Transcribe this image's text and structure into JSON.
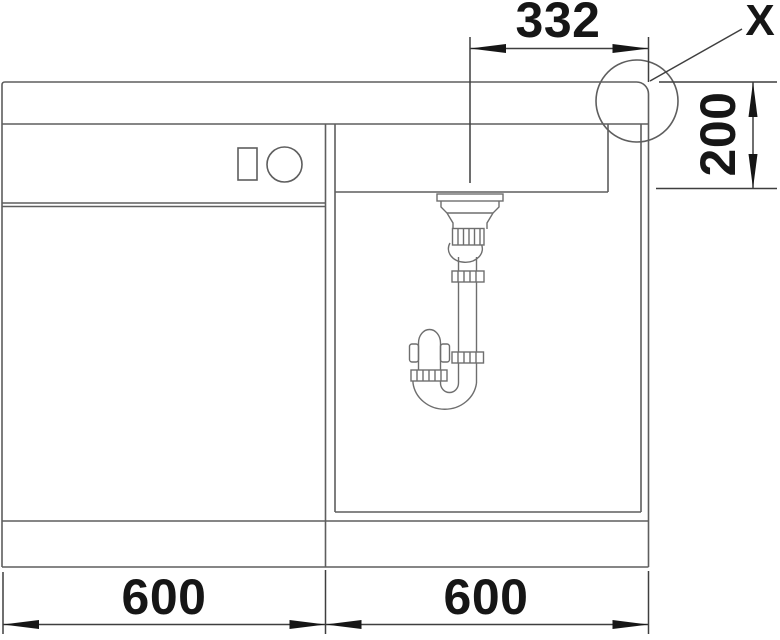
{
  "diagram": {
    "type": "technical-installation-drawing",
    "detail_label": "X",
    "dimensions": {
      "drain_center_to_right_edge": "332",
      "bowl_depth": "200",
      "left_cabinet_width": "600",
      "right_cabinet_width": "600"
    },
    "colors": {
      "background": "#ffffff",
      "structure_line": "#5e5e5e",
      "dimension_line": "#3f3f3f",
      "text": "#161616"
    }
  }
}
